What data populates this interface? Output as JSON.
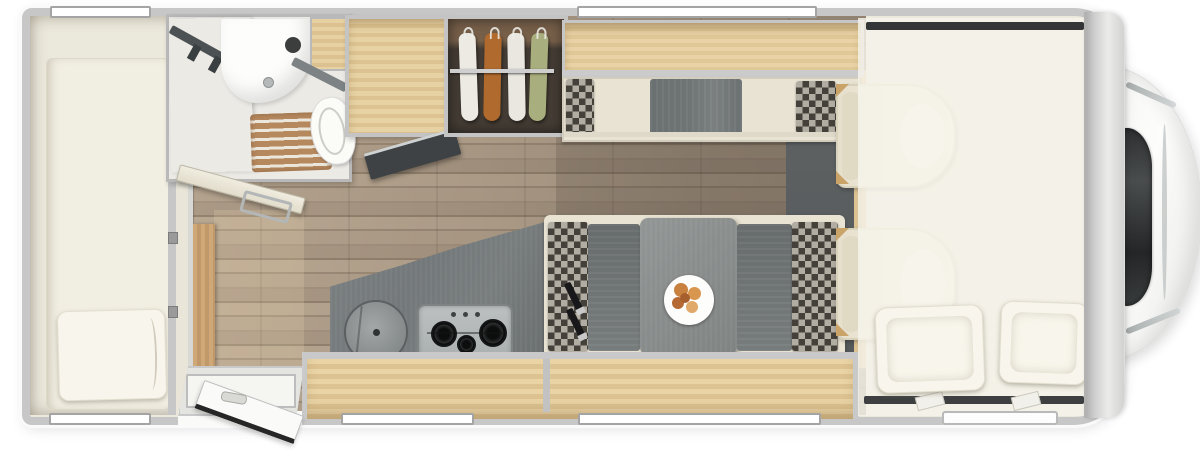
{
  "scene": {
    "kind": "motorhome-floorplan-top-view",
    "background": "#ffffff"
  },
  "palette": {
    "bg": "#ffffff",
    "wall": "#c7c7c7",
    "interior": "#ebe8dc",
    "bedCream": "#f1eee2",
    "pillow": "#f8f6ec",
    "woodLight": "#e7d1a3",
    "woodLight2": "#dcc290",
    "woodTrim": "#cfa878",
    "floorA": "#b4a38e",
    "floorB": "#93836f",
    "counter": "#73787a",
    "steel": "#bcc0c0",
    "cushion": "#6e7374",
    "checkerDark": "#44403a",
    "checkerLight": "#b2ada2",
    "benchCream": "#e9e3d3",
    "wardrobe": "#453d35",
    "wardrobeWood": "#77604a",
    "railSilver": "#cfcfcf",
    "clothesWhite": "#eceae2",
    "clothesOrange": "#b06a2e",
    "clothesWhite2": "#e9e7df",
    "clothesGreen": "#a9ae7e",
    "slatMat": "#b5885e",
    "slatLine": "#ece7dc",
    "cabFloor": "#54585a",
    "seatCream": "#eee8d8",
    "overlay": "rgba(246,243,234,0.84)",
    "darkStrip": "#333537",
    "windshield": "#36393a",
    "accentRed": "#c0392b",
    "tableGray": "#898d8c",
    "doorDark": "#3e4244",
    "beltBlack": "#18181a",
    "foodA": "#c8813f",
    "foodB": "#d9964f",
    "foodC": "#b56a33",
    "foodD": "#e0a869"
  },
  "layout": {
    "rear_bedroom": {
      "bed_pillows": 1,
      "windows": 2
    },
    "bathroom": {
      "fixtures": [
        "shower-blind",
        "washbasin",
        "toilet",
        "wood-slat-mat",
        "open-door-with-towel-rail"
      ]
    },
    "wardrobe": {
      "hanging_clothes": 4,
      "clothes_colors": [
        "white",
        "orange",
        "white",
        "green"
      ]
    },
    "kitchen": {
      "sink_shape": "round",
      "hob_burners": 3,
      "hob_knobs": 3
    },
    "dinette": {
      "side_bench": 1,
      "facing_benches": 2,
      "table_plate_items": 5,
      "seat_belts": 2
    },
    "cab": {
      "seats": 2,
      "overcab_bed_pillows": 2,
      "windshield": true
    },
    "walls": {
      "top_windows": 2,
      "bottom_windows": 3,
      "entry_door_open": true
    }
  }
}
